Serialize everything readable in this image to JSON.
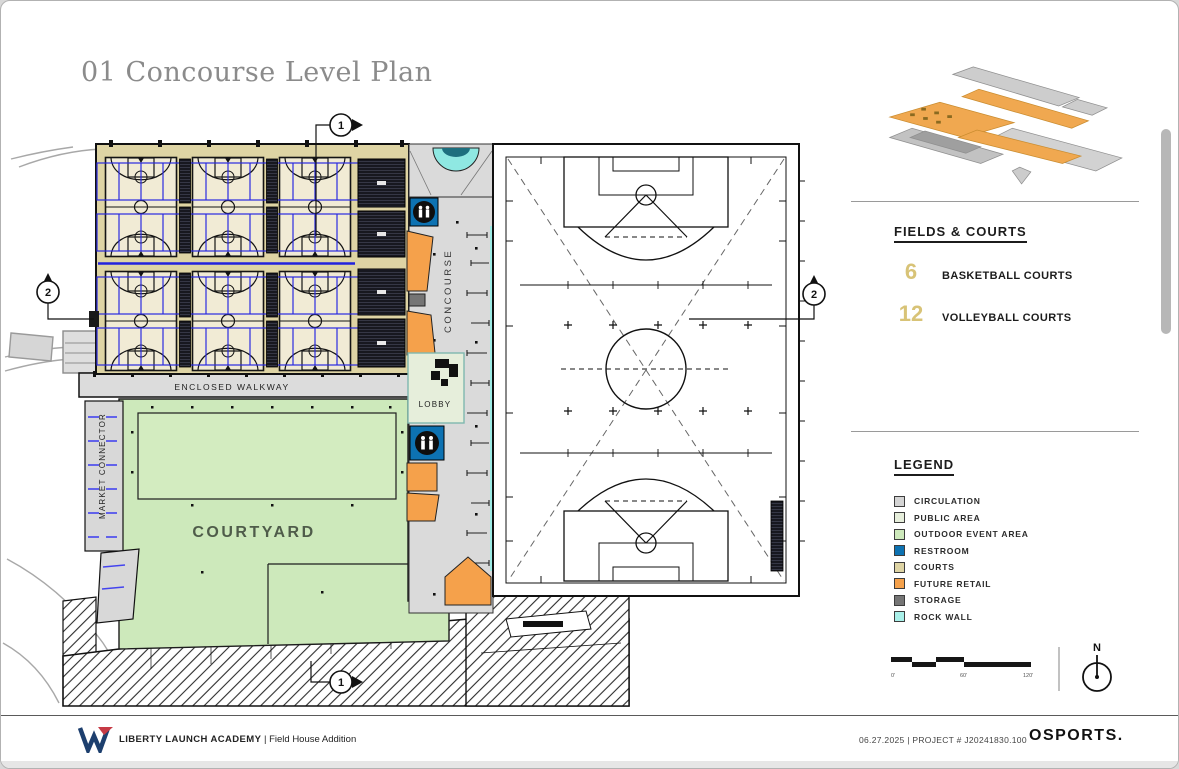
{
  "page": {
    "title": "01 Concourse Level Plan"
  },
  "plan": {
    "labels": {
      "enclosed_walkway": "ENCLOSED WALKWAY",
      "market_connector": "MARKET CONNECTOR",
      "concourse": "CONCOURSE",
      "lobby": "LOBBY",
      "courtyard": "COURTYARD"
    },
    "markers": {
      "section_one": "1",
      "section_two": "2"
    }
  },
  "sidebar": {
    "fields_courts": {
      "heading": "FIELDS & COURTS",
      "accent_color": "#d8c377",
      "items": [
        {
          "count": "6",
          "label": "BASKETBALL COURTS"
        },
        {
          "count": "12",
          "label": "VOLLEYBALL COURTS"
        }
      ]
    },
    "legend": {
      "heading": "LEGEND",
      "items": [
        {
          "label": "CIRCULATION",
          "color": "#d4d4d4"
        },
        {
          "label": "PUBLIC AREA",
          "color": "#e6eedb"
        },
        {
          "label": "OUTDOOR EVENT AREA",
          "color": "#cde9bb"
        },
        {
          "label": "RESTROOM",
          "color": "#0d72b2"
        },
        {
          "label": "COURTS",
          "color": "#ded4a4"
        },
        {
          "label": "FUTURE RETAIL",
          "color": "#f5a14b"
        },
        {
          "label": "STORAGE",
          "color": "#757575"
        },
        {
          "label": "ROCK WALL",
          "color": "#a9f0e9"
        }
      ]
    },
    "scale_bar": {
      "labels": [
        "0'",
        "60'",
        "120'"
      ]
    },
    "north_label": "N"
  },
  "footer": {
    "client": "LIBERTY LAUNCH ACADEMY",
    "project": "| Field House Addition",
    "meta": "06.27.2025 | PROJECT # J20241830.100",
    "brand": "OSPORTS."
  }
}
